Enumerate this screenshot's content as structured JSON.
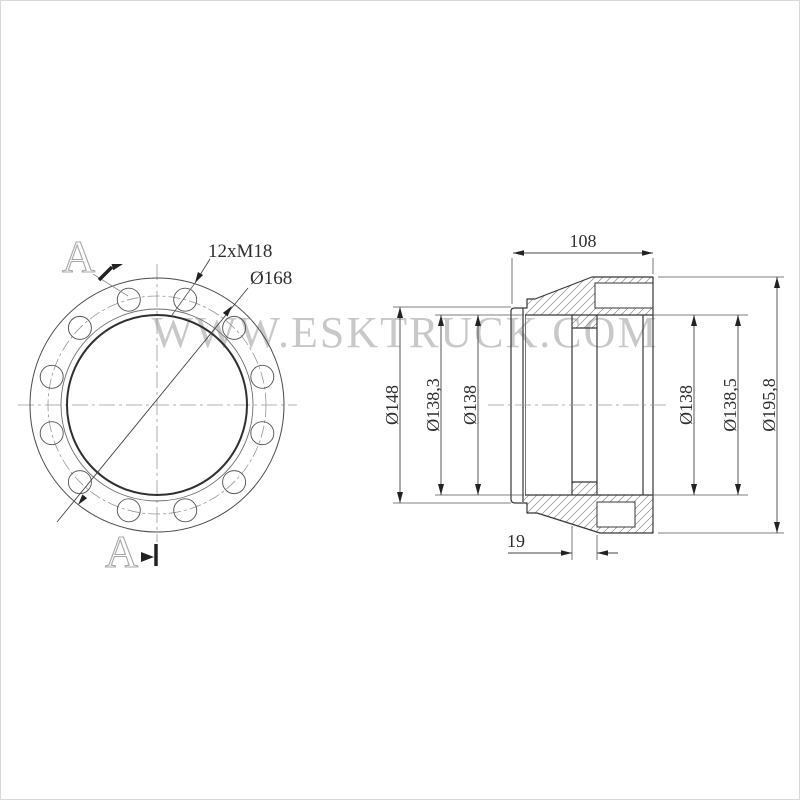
{
  "watermark": {
    "text": "WWW.ESKTRUCK.COM",
    "color": "#c8c8c8"
  },
  "front_view": {
    "section_marker_top": "A",
    "section_marker_bottom": "A",
    "bolt_spec_label": "12xM18",
    "bolt_circle_dia_label": "Ø168"
  },
  "side_view": {
    "top_width_label": "108",
    "rib_width_label": "19",
    "left_dims": [
      "Ø148",
      "Ø138,3",
      "Ø138"
    ],
    "right_dims": [
      "Ø138",
      "Ø138,5",
      "Ø195,8"
    ]
  },
  "colors": {
    "line_dark": "#373737",
    "line_medium": "#555555",
    "centerline": "#9a9a9a",
    "hatch": "#8a8a8a",
    "watermark": "#c8c8c8",
    "background": "#ffffff"
  }
}
